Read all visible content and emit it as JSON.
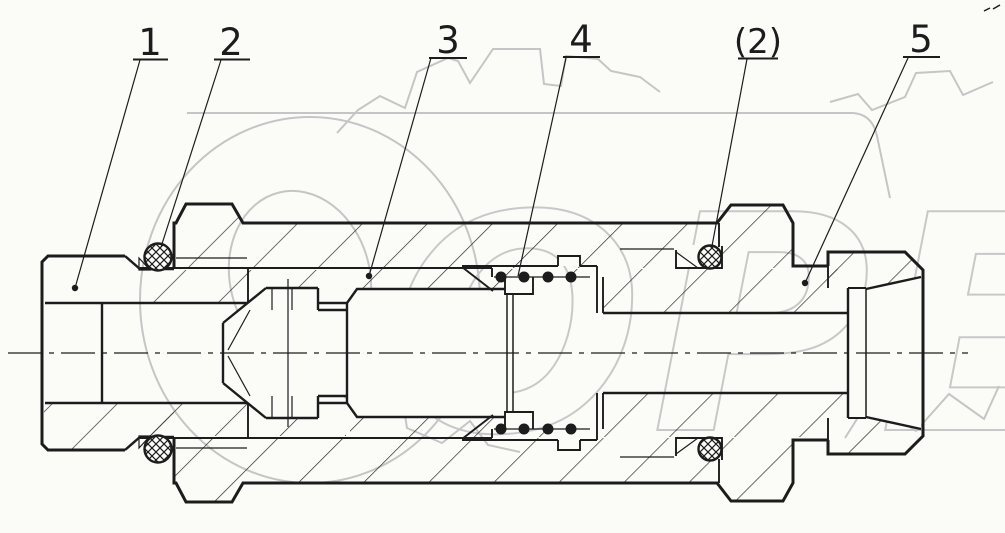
{
  "watermark": {
    "text": "OPEX"
  },
  "callouts": [
    {
      "label": "1"
    },
    {
      "label": "2"
    },
    {
      "label": "3"
    },
    {
      "label": "4"
    },
    {
      "label": "(2)"
    },
    {
      "label": "5"
    }
  ],
  "colors": {
    "line": "#1c1c1c",
    "watermark": "#c4c4c4",
    "background": "#fbfbf8"
  }
}
